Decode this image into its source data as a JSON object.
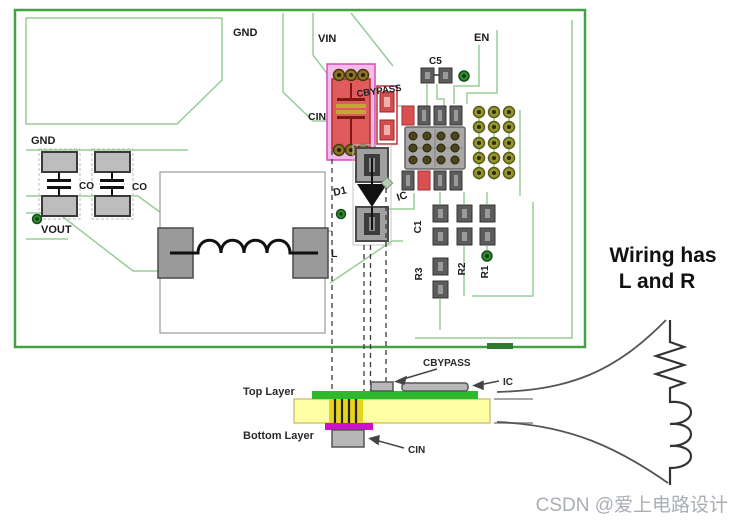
{
  "diagram": {
    "board": {
      "labels": {
        "gnd_top": "GND",
        "vin": "VIN",
        "en": "EN",
        "c5": "C5",
        "cbypass": "CBYPASS",
        "cin": "CIN",
        "gnd_left": "GND",
        "co_1": "CO",
        "co_2": "CO",
        "vout": "VOUT",
        "d1": "D1",
        "ic": "IC",
        "l": "L",
        "c1": "C1",
        "r3": "R3",
        "r2": "R2",
        "r1": "R1"
      }
    },
    "cross_section": {
      "top_layer_label": "Top Layer",
      "bottom_layer_label": "Bottom Layer",
      "cbypass_label": "CBYPASS",
      "ic_label": "IC",
      "cin_label": "CIN"
    },
    "annotation": {
      "line1": "Wiring has",
      "line2": "L and R"
    },
    "watermark": "CSDN @爱上电路设计",
    "colors": {
      "board_outline": "#44a244",
      "trace": "#97cd97",
      "copper_green": "#2eb82e",
      "substrate_yellow": "#ffffa3",
      "pad_magenta": "#cc10cc",
      "component_red": "#e05c5c",
      "highlight_pink": "#f6bce8",
      "via_green": "#2e8b2e",
      "via_olive": "#8a7326"
    }
  }
}
